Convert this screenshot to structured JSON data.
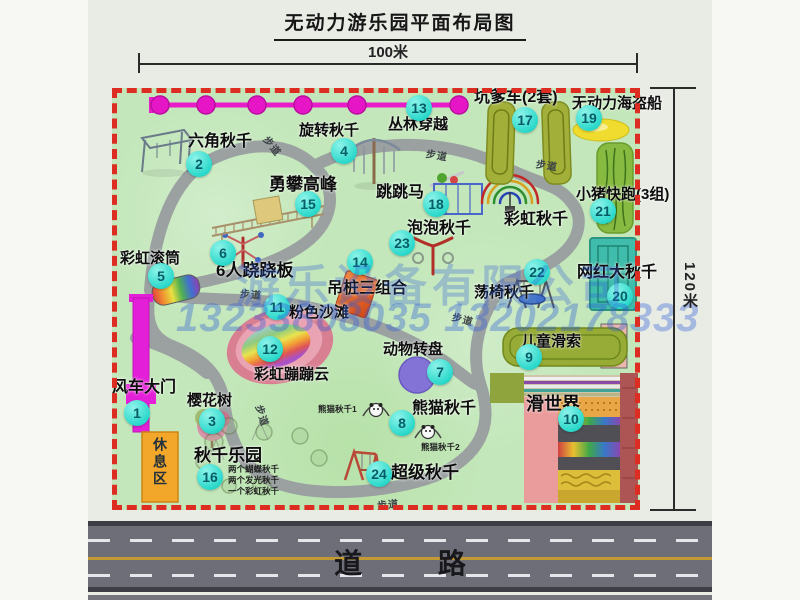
{
  "title": "无动力游乐园平面布局图",
  "dim_w": "100米",
  "dim_h": "120米",
  "road_label": "道 路",
  "path_label": "步道",
  "watermark": {
    "line1": "游乐设备有限公司",
    "line2": "13233808035 13202178333"
  },
  "extra": {
    "rainbow_swing": "彩虹秋千",
    "rest_area": "休息区",
    "panda1": "熊猫秋千1",
    "panda2": "熊猫秋千2"
  },
  "attractions": [
    {
      "num": "1",
      "name": "风车大门"
    },
    {
      "num": "2",
      "name": "六角秋千"
    },
    {
      "num": "3",
      "name": "樱花树"
    },
    {
      "num": "4",
      "name": "旋转秋千"
    },
    {
      "num": "5",
      "name": "彩虹滚筒"
    },
    {
      "num": "6",
      "name": "6人跷跷板"
    },
    {
      "num": "7",
      "name": "动物转盘"
    },
    {
      "num": "8",
      "name": "熊猫秋千"
    },
    {
      "num": "9",
      "name": "儿童滑索"
    },
    {
      "num": "10",
      "name": "滑世界"
    },
    {
      "num": "11",
      "name": "粉色沙滩"
    },
    {
      "num": "12",
      "name": "彩虹蹦蹦云"
    },
    {
      "num": "13",
      "name": "丛林穿越"
    },
    {
      "num": "14",
      "name": "吊桩三组合"
    },
    {
      "num": "15",
      "name": "勇攀高峰"
    },
    {
      "num": "16",
      "name": "秋千乐园",
      "notes": [
        "两个蝴蝶秋千",
        "两个发光秋千",
        "一个彩虹秋千"
      ]
    },
    {
      "num": "17",
      "name": "坑爹车(2套)"
    },
    {
      "num": "18",
      "name": "跳跳马"
    },
    {
      "num": "19",
      "name": "无动力海盗船"
    },
    {
      "num": "20",
      "name": "网红大秋千"
    },
    {
      "num": "21",
      "name": "小猪快跑(3组)"
    },
    {
      "num": "22",
      "name": "荡椅秋千"
    },
    {
      "num": "23",
      "name": "泡泡秋千"
    },
    {
      "num": "24",
      "name": "超级秋千"
    }
  ],
  "colors": {
    "map_green": "#c3e7ba",
    "border_red": "#dd2d22",
    "badge_teal": "#2bd9cb",
    "zipline_magenta": "#e81cc9",
    "gate_magenta": "#e41fd8",
    "road_gray": "#6e6e78",
    "watermark_blue": "#2d5cd7"
  }
}
